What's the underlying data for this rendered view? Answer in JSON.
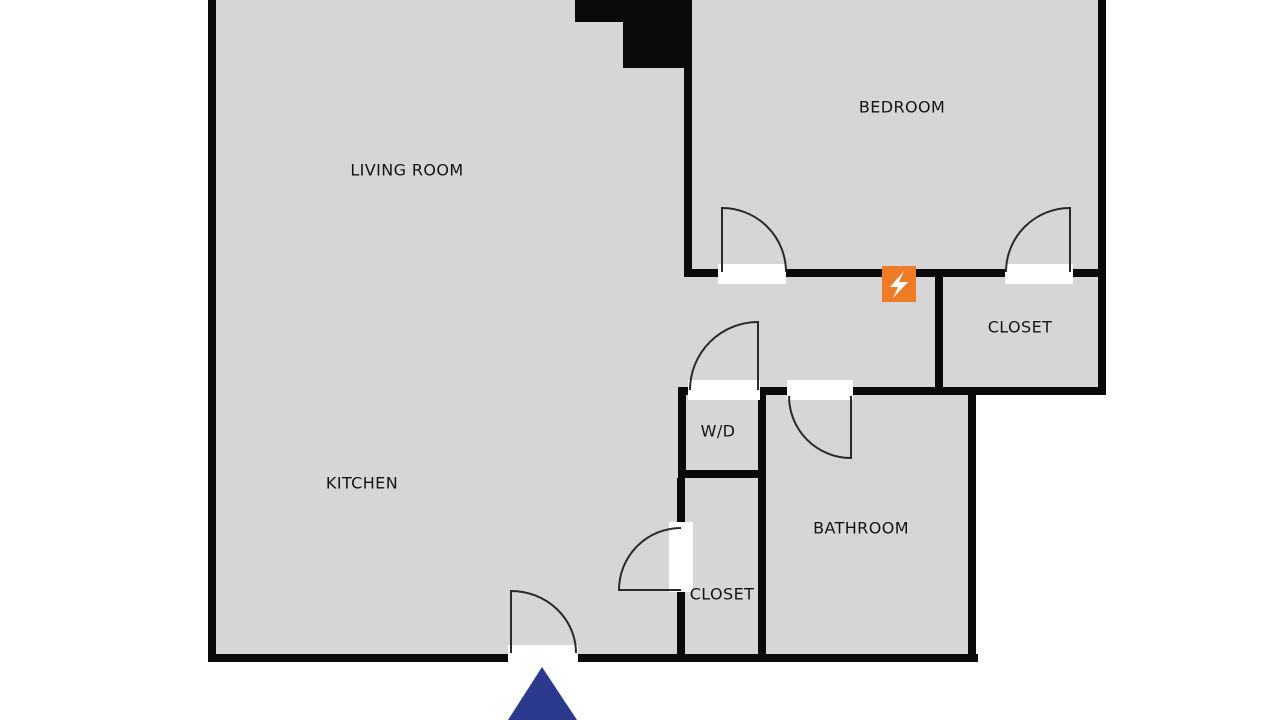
{
  "title": "Apartment floor plan",
  "labels": {
    "living_room": "LIVING ROOM",
    "bedroom": "BEDROOM",
    "bedroom_closet": "CLOSET",
    "washer_dryer": "W/D",
    "bathroom": "BATHROOM",
    "hall_closet": "CLOSET",
    "kitchen": "KITCHEN"
  },
  "markers": {
    "electrical_panel": "lightning-bolt-icon",
    "entry_viewpoint": "triangle-marker"
  },
  "colors": {
    "background": "#ffffff",
    "interior_floor": "#d6d6d6",
    "wall": "#0a0a0a",
    "door_swing_stroke": "#2a2a2a",
    "electrical_accent": "#ee7c26",
    "entry_marker": "#2b3a8c",
    "label_text": "#141414"
  }
}
